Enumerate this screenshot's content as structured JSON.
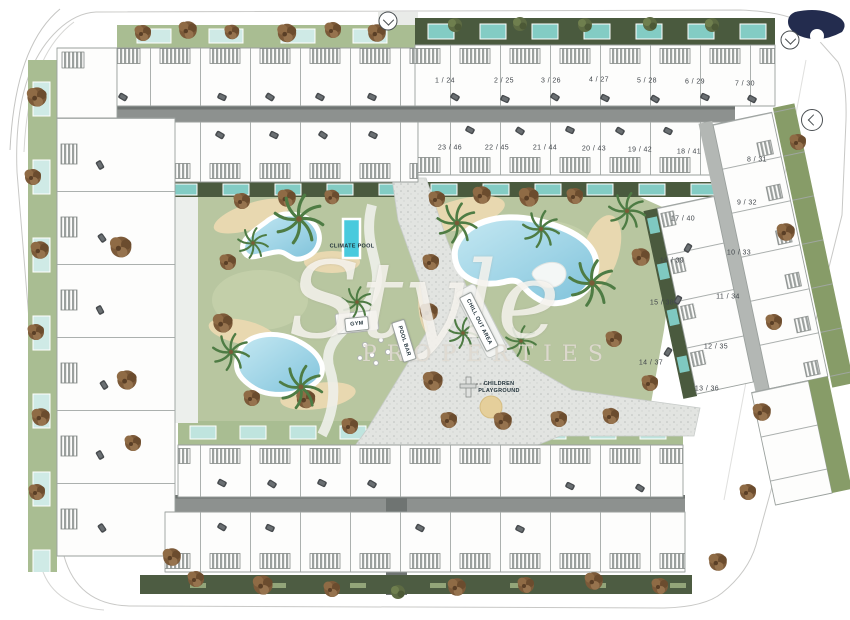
{
  "watermark": {
    "script": "Style",
    "sub": "PROPERTIES"
  },
  "amenities": {
    "climate_pool": "CLIMATE POOL",
    "gym": "GYM",
    "pool_bar": "POOL BAR",
    "chill_out_area": "CHILL OUT AREA",
    "children_playground_line1": "CHILDREN",
    "children_playground_line2": "PLAYGROUND"
  },
  "units": {
    "top_row": [
      "1 / 24",
      "2 / 25",
      "3 / 26",
      "4 / 27",
      "5 / 28",
      "6 / 29",
      "7 / 30"
    ],
    "second_row": [
      "23 / 46",
      "22 / 45",
      "21 / 44",
      "20 / 43",
      "19 / 42",
      "18 / 41"
    ],
    "right_outer": [
      "8 / 31",
      "9 / 32",
      "10 / 33",
      "11 / 34",
      "12 / 35",
      "13 / 36"
    ],
    "right_inner": [
      "17 / 40",
      "16 / 39",
      "15 / 38",
      "14 / 37"
    ]
  },
  "icons": {
    "entrance_top": "chevron-down",
    "entrance_right_top": "chevron-down",
    "entrance_right_side": "chevron-left"
  },
  "colors": {
    "lawn": "#b8c6a0",
    "sage_strip": "#a9bd92",
    "hedge_dark": "#4a5a3e",
    "pool_water": "#9fd4e6",
    "climate_pool": "#49cadd",
    "plunge_pool": "#83ccc4",
    "road": "#8d918f",
    "plaza": "#e3e5e2",
    "logo_navy": "#232c4e",
    "sand": "#e8d8b0"
  }
}
